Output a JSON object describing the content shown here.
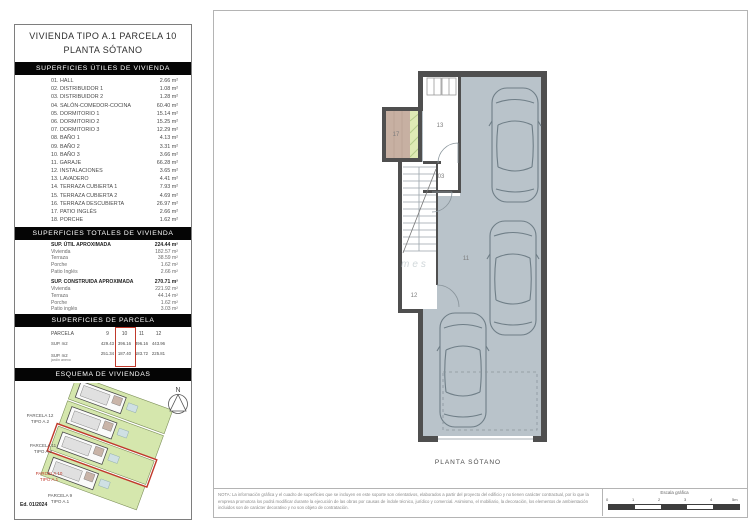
{
  "colors": {
    "accent_red": "#c0392b",
    "wall": "#4f4f4f",
    "garage_floor": "#b9c3ca",
    "parcel_green": "#d5e7ad",
    "patio_tan": "#c7b0a2",
    "patio_green": "#dfeab5"
  },
  "sidebar": {
    "title_line1": "VIVIENDA TIPO A.1 PARCELA 10",
    "title_line2": "PLANTA SÓTANO",
    "useful_surfaces": {
      "header": "SUPERFICIES ÚTILES DE VIVIENDA",
      "rows": [
        {
          "label": "01. HALL",
          "value": "2.66 m²"
        },
        {
          "label": "02. DISTRIBUIDOR 1",
          "value": "1.08 m²"
        },
        {
          "label": "03. DISTRIBUIDOR 2",
          "value": "1.28 m²"
        },
        {
          "label": "04. SALÓN-COMEDOR-COCINA",
          "value": "60.40 m²"
        },
        {
          "label": "05. DORMITORIO 1",
          "value": "15.14 m²"
        },
        {
          "label": "06. DORMITORIO 2",
          "value": "15.25 m²"
        },
        {
          "label": "07. DORMITORIO 3",
          "value": "12.29 m²"
        },
        {
          "label": "08. BAÑO 1",
          "value": "4.13 m²"
        },
        {
          "label": "09. BAÑO 2",
          "value": "3.31 m²"
        },
        {
          "label": "10. BAÑO 3",
          "value": "3.66 m²"
        },
        {
          "label": "11. GARAJE",
          "value": "66.28 m²"
        },
        {
          "label": "12. INSTALACIONES",
          "value": "3.65 m²"
        },
        {
          "label": "13. LAVADERO",
          "value": "4.41 m²"
        },
        {
          "label": "14. TERRAZA CUBIERTA 1",
          "value": "7.93 m²"
        },
        {
          "label": "15. TERRAZA CUBIERTA 2",
          "value": "4.69 m²"
        },
        {
          "label": "16. TERRAZA DESCUBIERTA",
          "value": "26.97 m²"
        },
        {
          "label": "17. PATIO INGLÉS",
          "value": "2.66 m²"
        },
        {
          "label": "18. PORCHE",
          "value": "1.62 m²"
        }
      ]
    },
    "total_surfaces": {
      "header": "SUPERFICIES TOTALES DE VIVIENDA",
      "groups": [
        {
          "label": "SUP. ÚTIL APROXIMADA",
          "value": "224.44 m²",
          "items": [
            {
              "label": "Vivienda",
              "value": "182.57 m²"
            },
            {
              "label": "Terraza",
              "value": "38.59 m²"
            },
            {
              "label": "Porche",
              "value": "1.62 m²"
            },
            {
              "label": "Patio Inglés",
              "value": "2.66 m²"
            }
          ]
        },
        {
          "label": "SUP. CONSTRUIDA APROXIMADA",
          "value": "270.71 m²",
          "items": [
            {
              "label": "Vivienda",
              "value": "221.92 m²"
            },
            {
              "label": "Terraza",
              "value": "44.14 m²"
            },
            {
              "label": "Porche",
              "value": "1.62 m²"
            },
            {
              "label": "Patio inglés",
              "value": "3.03 m²"
            }
          ]
        }
      ]
    },
    "parcel_surfaces": {
      "header": "SUPERFICIES DE PARCELA",
      "highlight_column": "10",
      "rows": [
        {
          "label": "PARCELA",
          "sublabel": "",
          "values": [
            "9",
            "10",
            "11",
            "12"
          ]
        },
        {
          "label": "SUP. m2",
          "sublabel": "",
          "values": [
            "429.43",
            "396.16",
            "396.16",
            "443.96"
          ]
        },
        {
          "label": "SUP. m2",
          "sublabel": "jardín anexo",
          "values": [
            "251.34",
            "187.40",
            "183.72",
            "225.81"
          ]
        }
      ]
    },
    "scheme": {
      "header": "ESQUEMA DE VIVIENDAS",
      "north_label": "N",
      "edition": "Ed. 01/2024",
      "parcels": [
        {
          "name": "PARCELA 12",
          "type": "TIPO A.2",
          "highlight": false
        },
        {
          "name": "PARCELA 11",
          "type": "TIPO A.2",
          "highlight": false
        },
        {
          "name": "PARCELA 10",
          "type": "TIPO A.1",
          "highlight": true
        },
        {
          "name": "PARCELA 9",
          "type": "TIPO A.1",
          "highlight": false
        }
      ]
    }
  },
  "plan": {
    "caption": "PLANTA SÓTANO",
    "watermark": "mes",
    "room_labels": {
      "patio": "17",
      "lavadero": "13",
      "distribuidor": "03",
      "instalaciones": "12",
      "garaje": "11"
    }
  },
  "footer": {
    "note_lines": [
      "NOTA: La información gráfica y el cuadro de superficies que se incluyen en este soporte son orientativos, elaborados a partir del proyecto del edificio y no tienen carácter contractual, por lo que la",
      "empresa promotora los podrá modificar durante la ejecución de las obras por causas de índole técnico, jurídico y comercial. Asimismo, el mobiliario, la decoración, los elementos de ambientación",
      "incluidos son de carácter decorativo y no son objeto de contratación."
    ],
    "scale_label": "Escala gráfica",
    "scale_ticks": [
      "0",
      "1",
      "2",
      "3",
      "4",
      "5m"
    ]
  }
}
